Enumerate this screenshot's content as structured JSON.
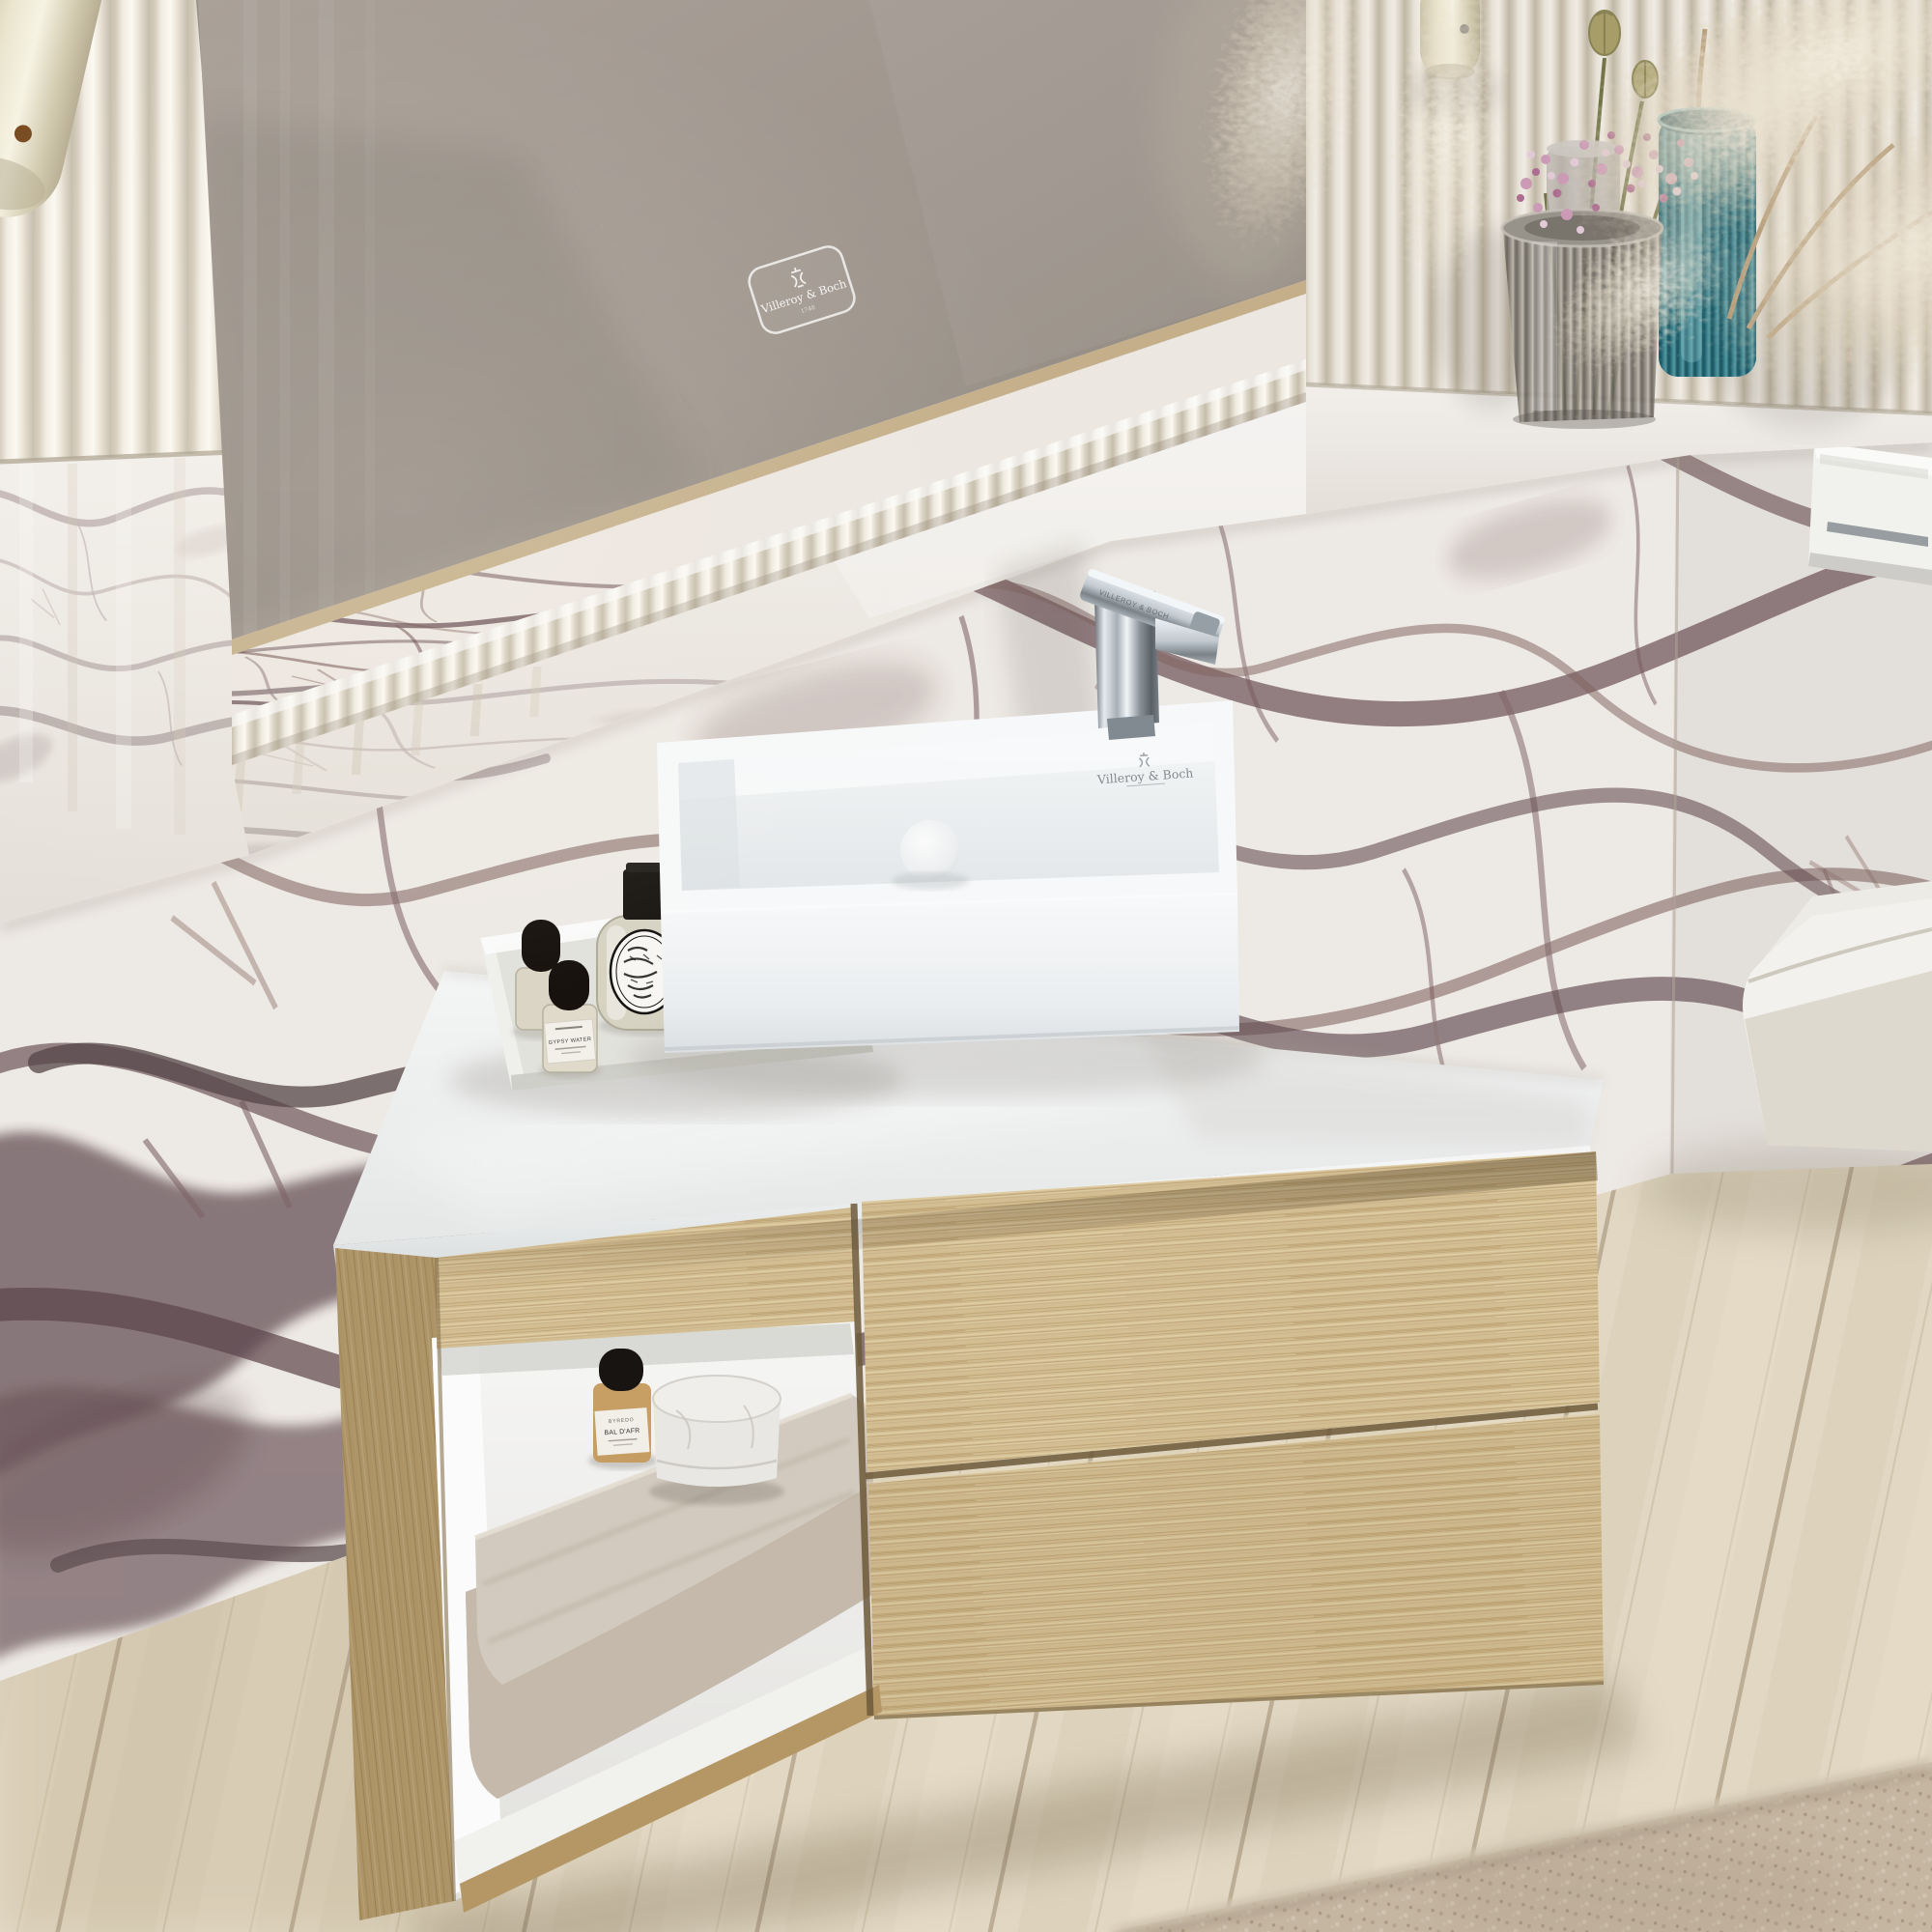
{
  "branding": {
    "name": "Villeroy & Boch",
    "mirror_badge": "Villeroy & Boch",
    "mirror_badge_year": "1748",
    "basin_logo": "Villeroy & Boch",
    "faucet_engraving": "VILLEROY & BOCH"
  },
  "products": {
    "candle": {
      "label_line1": "BA",
      "label_line2": "IES"
    },
    "perfume_mini": {
      "label": "GYPSY WATER"
    },
    "shelf_bottle": {
      "brand": "BYREDO",
      "label": "BAL D'AFR"
    }
  },
  "palette": {
    "mirror_taupe": "#a19890",
    "fluted_white": "#f1ece2",
    "marble_base": "#efeae4",
    "marble_vein": "#55343b",
    "oak": "#d7c196",
    "counter_white": "#f7f8f8",
    "chrome": "#ced5db",
    "teal_vase": "#2e7d8c",
    "grey_vase": "#8a867f",
    "floor_wood": "#e2d8c3",
    "rug_beige": "#c8b9a5",
    "towel_greige": "#cfc5b8"
  },
  "scene_objects": [
    "led-mirror",
    "pendant-lamp",
    "wall-sconce-lamp",
    "fluted-wall-panel",
    "marble-ledge",
    "grey-ribbed-vase",
    "teal-ribbed-vase",
    "gypsophila-flowers",
    "poppy-seed-pods",
    "pampas-grass",
    "surface-mounted-washbasin",
    "single-lever-faucet",
    "white-countertop",
    "vanity-tray",
    "diptyque-perfume-bottle",
    "cosmetic-jar",
    "baies-candle",
    "gypsy-water-bottle",
    "oak-vanity-cabinet",
    "open-shelf-niche",
    "folded-towels",
    "bal-dafrique-bottle",
    "marble-trinket-jar",
    "toilet-flush-plate",
    "wall-hung-toilet",
    "wood-plank-floor",
    "area-rug"
  ]
}
